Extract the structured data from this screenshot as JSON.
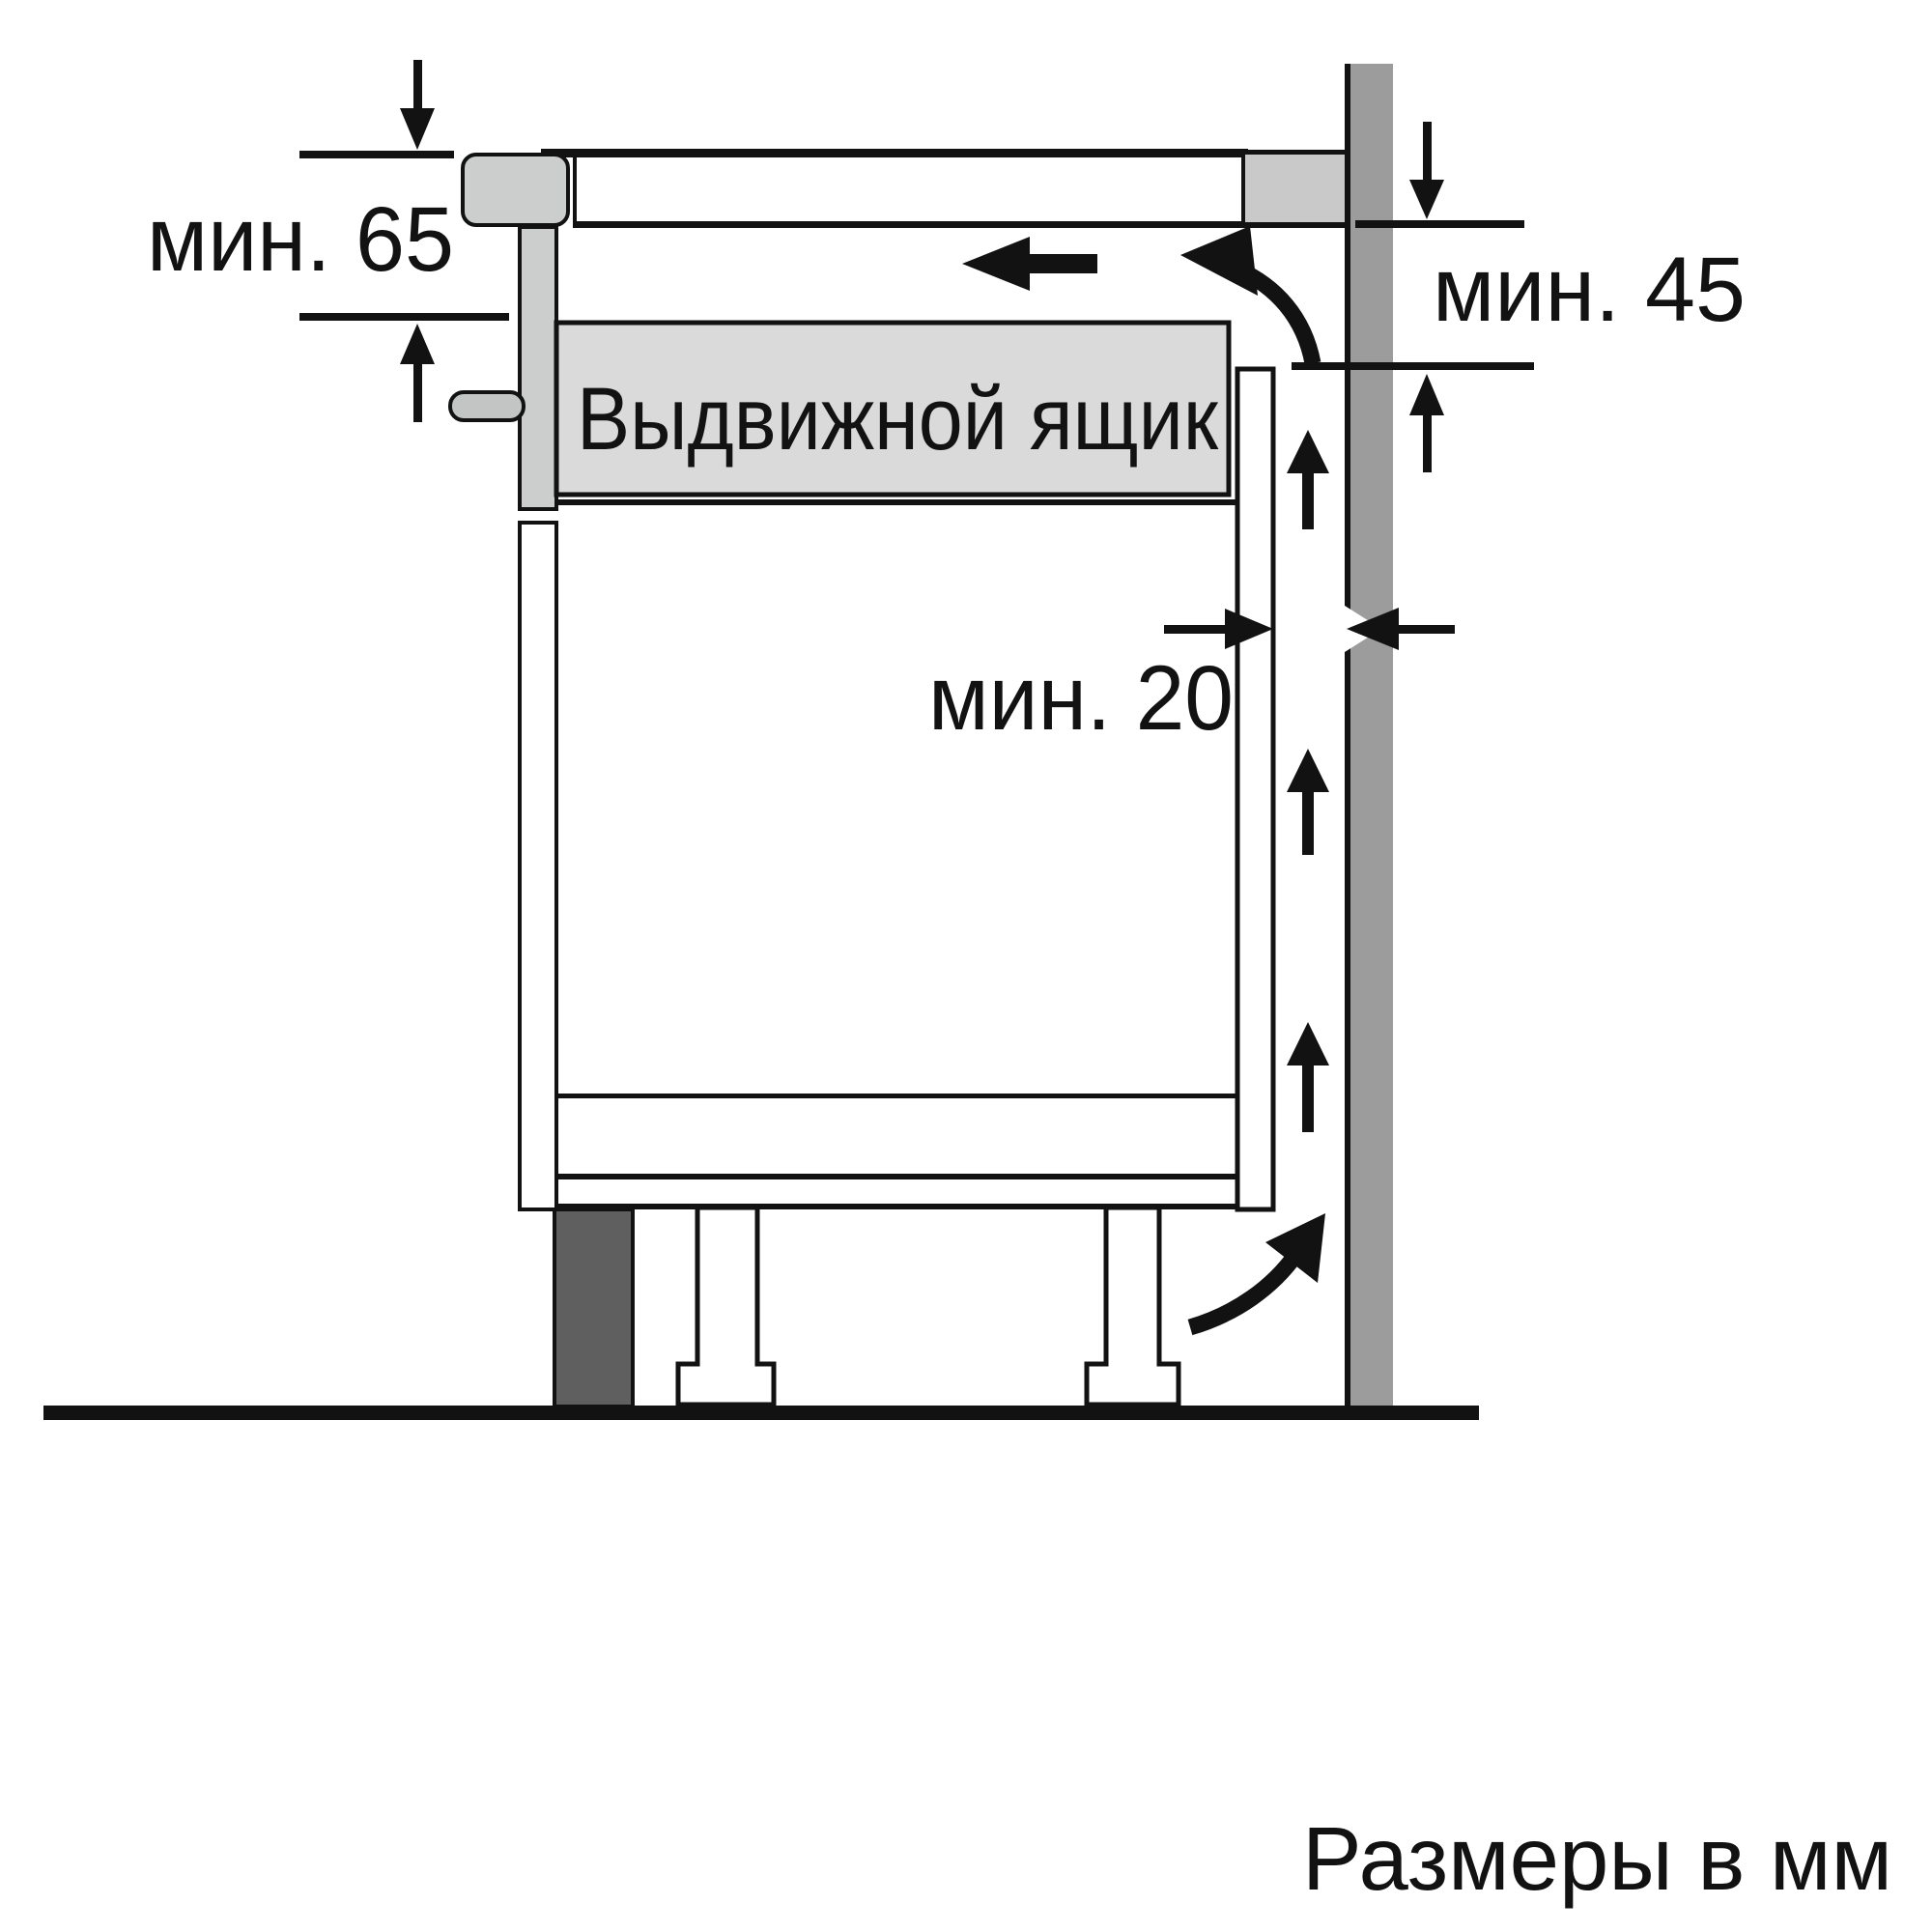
{
  "diagram": {
    "title_hidden": "",
    "caption": "Размеры в мм",
    "labels": {
      "hob_side_clearance": "мин. 65",
      "wall_clearance": "мин. 45",
      "rear_gap": "мин. 20",
      "drawer": "Выдвижной ящик"
    },
    "colors": {
      "background": "#ffffff",
      "line": "#121212",
      "wall": "#9c9c9c",
      "worktop_end": "#c9c9c9",
      "hob": "#cbcecd",
      "knob": "#c2c5c4",
      "drawer": "#dadada",
      "plinth": "#5f5f5f"
    }
  }
}
